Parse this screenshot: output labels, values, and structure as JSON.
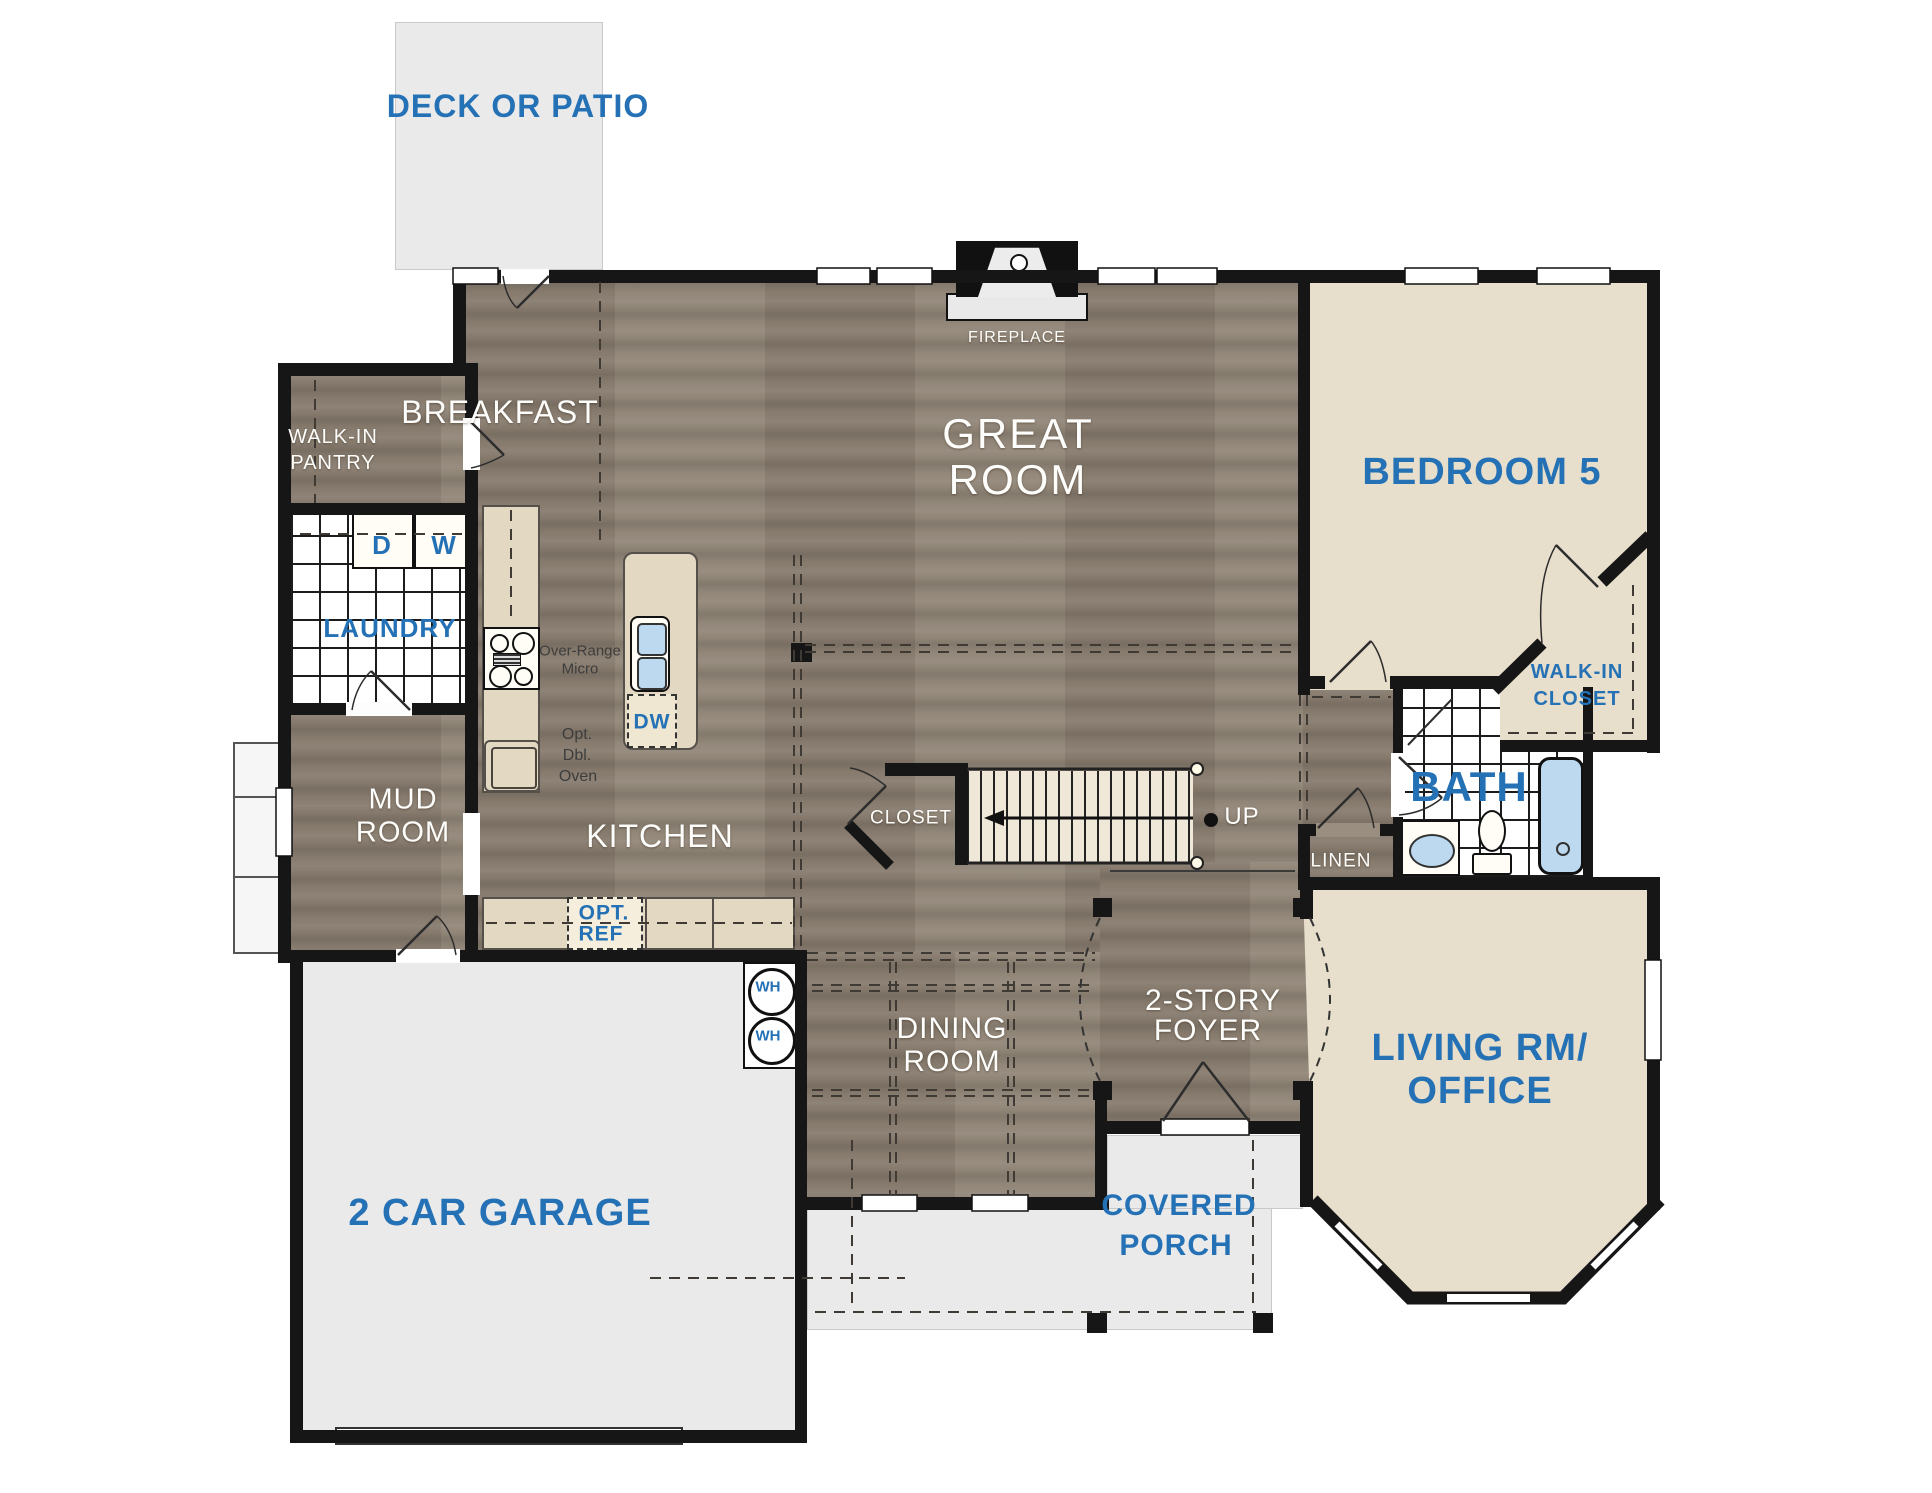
{
  "rooms": {
    "deck": {
      "label": "DECK OR PATIO"
    },
    "breakfast": {
      "label": "BREAKFAST"
    },
    "great_room": {
      "line1": "GREAT",
      "line2": "ROOM"
    },
    "fireplace": {
      "label": "FIREPLACE"
    },
    "bedroom5": {
      "label": "BEDROOM 5"
    },
    "walk_in_pantry": {
      "line1": "WALK-IN",
      "line2": "PANTRY"
    },
    "laundry": {
      "label": "LAUNDRY"
    },
    "mud_room": {
      "line1": "MUD",
      "line2": "ROOM"
    },
    "kitchen": {
      "label": "KITCHEN"
    },
    "closet": {
      "label": "CLOSET"
    },
    "stairs": {
      "direction": "UP"
    },
    "walk_in_closet": {
      "line1": "WALK-IN",
      "line2": "CLOSET"
    },
    "bath": {
      "label": "BATH"
    },
    "linen": {
      "label": "LINEN"
    },
    "dining_room": {
      "line1": "DINING",
      "line2": "ROOM"
    },
    "foyer": {
      "line1": "2-STORY",
      "line2": "FOYER"
    },
    "living_office": {
      "line1": "LIVING RM/",
      "line2": "OFFICE"
    },
    "garage": {
      "label": "2 CAR GARAGE"
    },
    "covered_porch": {
      "line1": "COVERED",
      "line2": "PORCH"
    }
  },
  "appliances": {
    "dryer": "D",
    "washer": "W",
    "water_heater_1": "WH",
    "water_heater_2": "WH",
    "dishwasher": "DW",
    "over_range_micro": {
      "line1": "Over-Range",
      "line2": "Micro"
    },
    "opt_dbl_oven": {
      "line1": "Opt.",
      "line2": "Dbl.",
      "line3": "Oven"
    },
    "opt_ref": {
      "line1": "OPT.",
      "line2": "REF"
    }
  },
  "colors": {
    "label_blue": "#2471b5",
    "wood_floor": "#8d8173",
    "beige_floor": "#e7decb",
    "gray_floor": "#eaeaea",
    "wall_black": "#161616",
    "fixture_blue": "#bcd9f0"
  }
}
